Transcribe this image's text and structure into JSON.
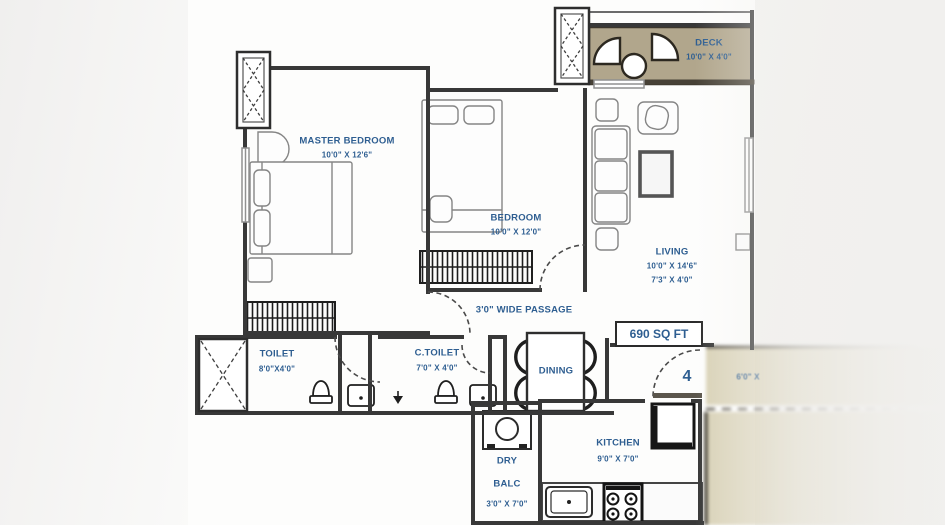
{
  "plan": {
    "area_label": "690 SQ FT",
    "unit_number": "4",
    "passage_label": "3'0\" WIDE PASSAGE",
    "corridor_dim": "6'0\" X",
    "rooms": {
      "master_bedroom": {
        "name": "MASTER BEDROOM",
        "dim": "10'0\" X 12'6\""
      },
      "bedroom": {
        "name": "BEDROOM",
        "dim": "10'0\" X 12'0\""
      },
      "living": {
        "name": "LIVING",
        "dim": "10'0\" X 14'6\"",
        "dim2": "7'3\" X 4'0\""
      },
      "deck": {
        "name": "DECK",
        "dim": "10'0\" X 4'0\""
      },
      "toilet": {
        "name": "TOILET",
        "dim": "8'0\"X4'0\""
      },
      "c_toilet": {
        "name": "C.TOILET",
        "dim": "7'0\" X 4'0\""
      },
      "dining": {
        "name": "DINING"
      },
      "kitchen": {
        "name": "KITCHEN",
        "dim": "9'0\" X 7'0\""
      },
      "dry_balcony": {
        "name_line1": "DRY",
        "name_line2": "BALC",
        "dim": "3'0\" X 7'0\""
      }
    },
    "colors": {
      "label_text": "#2e5e91",
      "wall": "#3a3a3a",
      "deck_fill": "#b1a68c",
      "corridor_fill": "#d9d2b7"
    }
  }
}
